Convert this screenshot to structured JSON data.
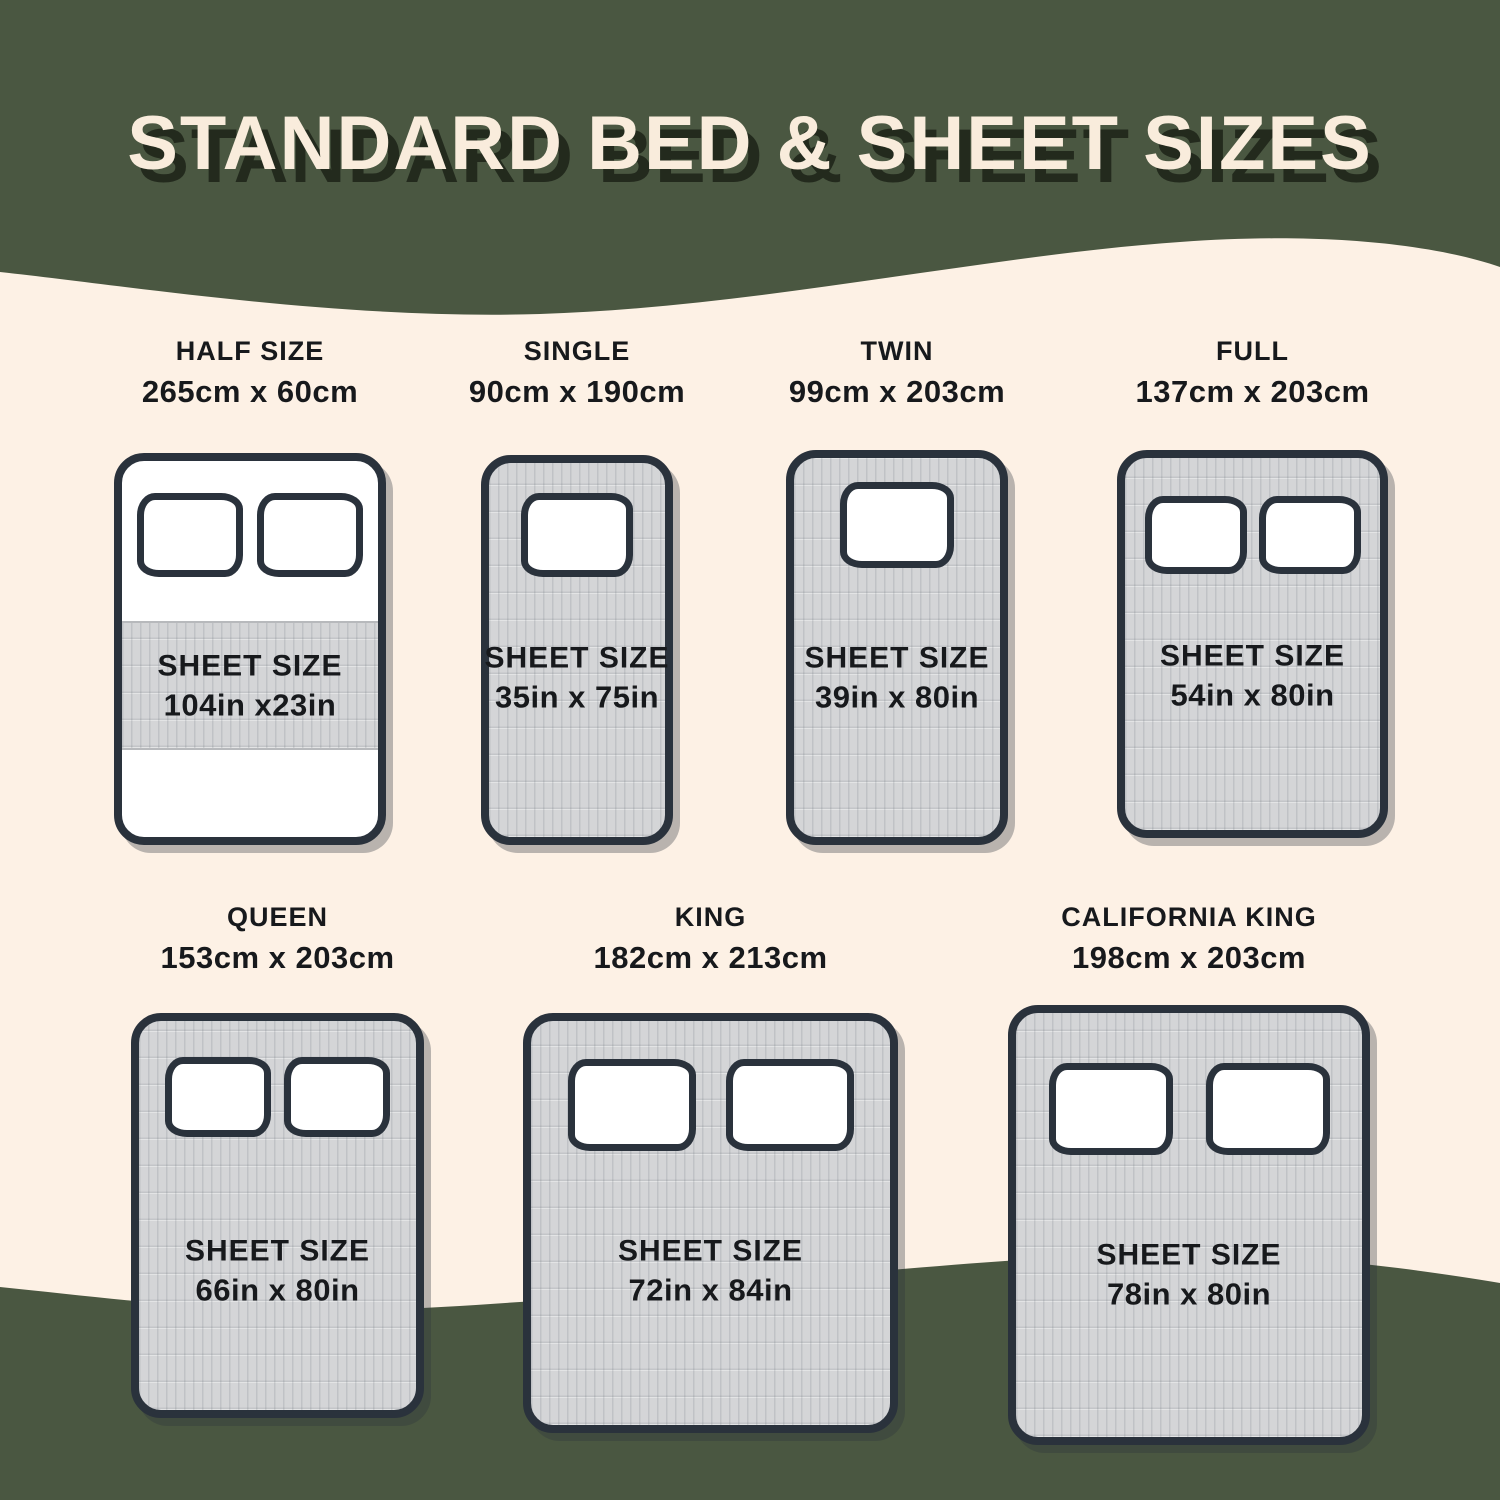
{
  "title": "STANDARD BED & SHEET SIZES",
  "palette": {
    "green": "#4a5741",
    "cream": "#fdf1e5",
    "outline": "#2a323c",
    "sheet_gray": "#d4d5d7",
    "text": "#17191c",
    "title_color": "#f9ecdc"
  },
  "sheet_label": "SHEET SIZE",
  "beds": [
    {
      "name": "HALF SIZE",
      "dimensions": "265cm x 60cm",
      "sheet_size": "104in x23in",
      "pillows": 2
    },
    {
      "name": "SINGLE",
      "dimensions": "90cm x 190cm",
      "sheet_size": "35in x 75in",
      "pillows": 1
    },
    {
      "name": "TWIN",
      "dimensions": "99cm x 203cm",
      "sheet_size": "39in x 80in",
      "pillows": 1
    },
    {
      "name": "FULL",
      "dimensions": "137cm x 203cm",
      "sheet_size": "54in x 80in",
      "pillows": 2
    },
    {
      "name": "QUEEN",
      "dimensions": "153cm x 203cm",
      "sheet_size": "66in x 80in",
      "pillows": 2
    },
    {
      "name": "KING",
      "dimensions": "182cm x 213cm",
      "sheet_size": "72in x 84in",
      "pillows": 2
    },
    {
      "name": "CALIFORNIA KING",
      "dimensions": "198cm x 203cm",
      "sheet_size": "78in x 80in",
      "pillows": 2
    }
  ]
}
